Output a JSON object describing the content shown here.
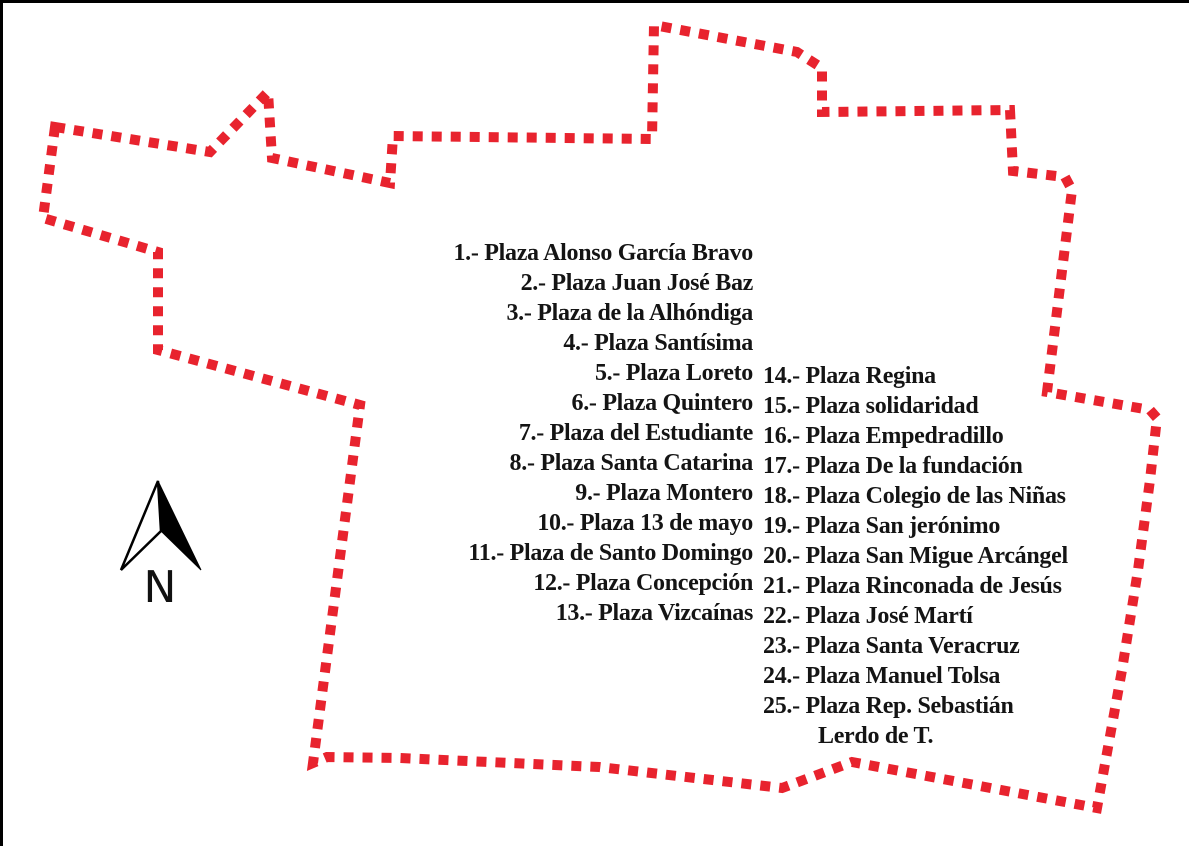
{
  "legend": {
    "left_items": [
      "1.- Plaza Alonso García Bravo",
      "2.- Plaza Juan José Baz",
      "3.- Plaza de la Alhóndiga",
      "4.- Plaza Santísima",
      "5.- Plaza Loreto",
      "6.- Plaza Quintero",
      "7.- Plaza del Estudiante",
      "8.- Plaza Santa Catarina",
      "9.- Plaza Montero",
      "10.- Plaza 13 de mayo",
      "11.- Plaza de Santo Domingo",
      "12.- Plaza Concepción",
      "13.- Plaza Vizcaínas"
    ],
    "right_items": [
      "14.- Plaza Regina",
      "15.- Plaza solidaridad",
      "16.- Plaza Empedradillo",
      "17.- Plaza De la fundación",
      "18.- Plaza Colegio de las Niñas",
      "19.- Plaza San jerónimo",
      "20.- Plaza San Migue Arcángel",
      "21.- Plaza Rinconada de Jesús",
      "22.- Plaza José Martí",
      "23.- Plaza Santa Veracruz",
      "24.- Plaza Manuel Tolsa",
      "25.- Plaza Rep. Sebastián"
    ],
    "right_continuation": "Lerdo de T."
  },
  "compass": {
    "label": "N"
  },
  "colors": {
    "boundary": "#e8232e",
    "frame": "#000000",
    "text": "#141414"
  }
}
